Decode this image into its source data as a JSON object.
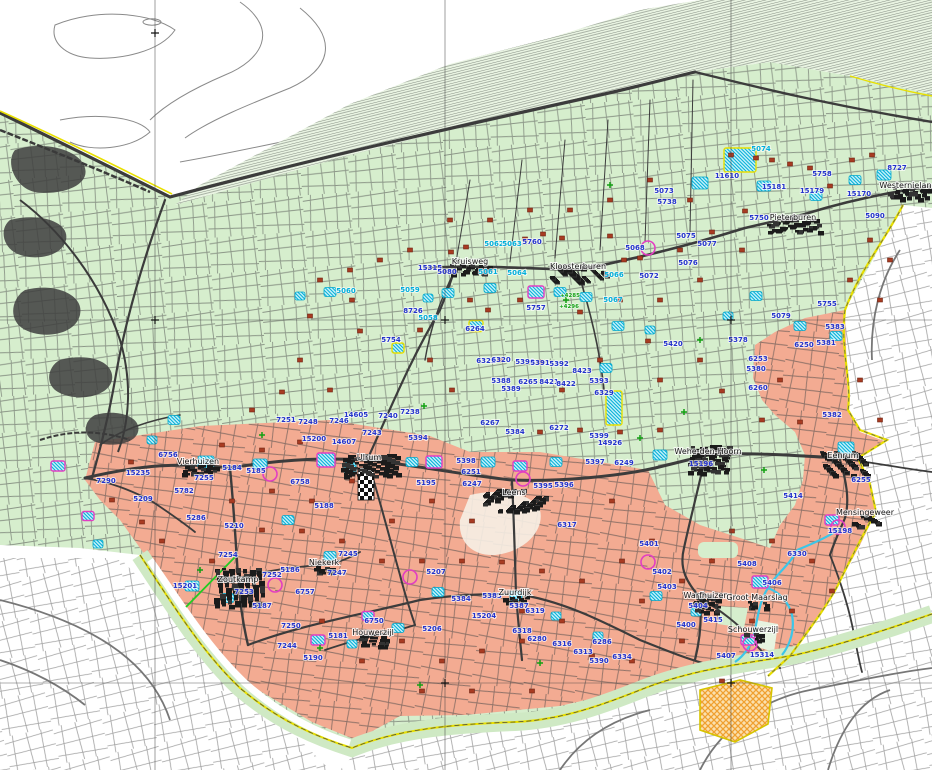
{
  "map_title": "Topographic cadastral map - Noord-Groningen",
  "colors": {
    "green_region": "#d6eecd",
    "marsh_region": "#e9f4e2",
    "salmon_region": "#f3ab92",
    "blue_label": "#2333cc",
    "cyan_label": "#00aeda",
    "green_label": "#12a012",
    "road": "#3c3c3c",
    "light_parcel": "#8f8f8f",
    "yellow_boundary": "#e8df00",
    "river": "#3cc6e8",
    "farm_marker": "#a83b22",
    "magenta_marker": "#e23ec2",
    "orange_hatch": "#f0a030",
    "town_text": "#151515"
  },
  "towns": [
    {
      "name": "Kruisweg",
      "x": 470,
      "y": 264,
      "bw": 40,
      "bh": 10
    },
    {
      "name": "Kloosterburen",
      "x": 578,
      "y": 269,
      "bw": 56,
      "bh": 16
    },
    {
      "name": "Pieterburen",
      "x": 793,
      "y": 220,
      "bw": 52,
      "bh": 14
    },
    {
      "name": "Westernieland",
      "x": 908,
      "y": 188,
      "bw": 42,
      "bh": 12
    },
    {
      "name": "Vierhuizen",
      "x": 198,
      "y": 464,
      "bw": 34,
      "bh": 10
    },
    {
      "name": "Ulrum",
      "x": 369,
      "y": 460,
      "bw": 56,
      "bh": 22
    },
    {
      "name": "Leens",
      "x": 514,
      "y": 495,
      "bw": 62,
      "bh": 22
    },
    {
      "name": "Wehe-den-Hoorn",
      "x": 708,
      "y": 454,
      "bw": 40,
      "bh": 28
    },
    {
      "name": "Eenrum",
      "x": 843,
      "y": 458,
      "bw": 46,
      "bh": 24
    },
    {
      "name": "Mensingeweer",
      "x": 865,
      "y": 515,
      "bw": 26,
      "bh": 12
    },
    {
      "name": "Zoutkamp",
      "x": 238,
      "y": 582,
      "bw": 48,
      "bh": 38
    },
    {
      "name": "Niekerk",
      "x": 324,
      "y": 565,
      "bw": 20,
      "bh": 8
    },
    {
      "name": "Houwerzijl",
      "x": 373,
      "y": 635,
      "bw": 28,
      "bh": 12
    },
    {
      "name": "Zuurdijk",
      "x": 515,
      "y": 595,
      "bw": 24,
      "bh": 8
    },
    {
      "name": "Warfhuizen",
      "x": 706,
      "y": 598,
      "bw": 26,
      "bh": 18
    },
    {
      "name": "Groot Maarslag",
      "x": 757,
      "y": 600,
      "bw": 18,
      "bh": 8
    },
    {
      "name": "Schouwerzijl",
      "x": 753,
      "y": 632,
      "bw": 18,
      "bh": 8
    }
  ],
  "labels_blue": [
    [
      "11610",
      727,
      178
    ],
    [
      "15181",
      774,
      189
    ],
    [
      "5758",
      822,
      176
    ],
    [
      "15179",
      812,
      193
    ],
    [
      "15170",
      859,
      196
    ],
    [
      "8727",
      897,
      170
    ],
    [
      "5750",
      759,
      220
    ],
    [
      "5090",
      875,
      218
    ],
    [
      "5760",
      532,
      244
    ],
    [
      "15315",
      430,
      270
    ],
    [
      "5080",
      447,
      274
    ],
    [
      "5757",
      536,
      310
    ],
    [
      "8726",
      413,
      313
    ],
    [
      "5754",
      391,
      342
    ],
    [
      "6264",
      475,
      331
    ],
    [
      "14605",
      356,
      417
    ],
    [
      "7240",
      388,
      418
    ],
    [
      "7238",
      410,
      414
    ],
    [
      "7251",
      286,
      422
    ],
    [
      "7248",
      308,
      424
    ],
    [
      "7246",
      339,
      423
    ],
    [
      "7243",
      372,
      435
    ],
    [
      "15200",
      314,
      441
    ],
    [
      "14607",
      344,
      444
    ],
    [
      "6756",
      168,
      457
    ],
    [
      "5184",
      232,
      470
    ],
    [
      "7255",
      204,
      480
    ],
    [
      "5185",
      256,
      473
    ],
    [
      "6758",
      300,
      484
    ],
    [
      "5782",
      184,
      493
    ],
    [
      "5286",
      196,
      520
    ],
    [
      "5210",
      234,
      528
    ],
    [
      "5188",
      324,
      508
    ],
    [
      "7290",
      106,
      483
    ],
    [
      "15235",
      138,
      475
    ],
    [
      "5209",
      143,
      501
    ],
    [
      "5394",
      418,
      440
    ],
    [
      "5195",
      426,
      485
    ],
    [
      "5398",
      466,
      463
    ],
    [
      "6251",
      471,
      474
    ],
    [
      "6247",
      472,
      486
    ],
    [
      "14926",
      610,
      445
    ],
    [
      "5397",
      595,
      464
    ],
    [
      "6249",
      624,
      465
    ],
    [
      "5395",
      543,
      488
    ],
    [
      "5396",
      564,
      487
    ],
    [
      "6317",
      567,
      527
    ],
    [
      "15196",
      701,
      466
    ],
    [
      "5414",
      793,
      498
    ],
    [
      "5382",
      832,
      417
    ],
    [
      "6255",
      861,
      482
    ],
    [
      "15198",
      840,
      533
    ],
    [
      "7254",
      228,
      557
    ],
    [
      "15201",
      185,
      588
    ],
    [
      "7252",
      272,
      577
    ],
    [
      "7253",
      244,
      594
    ],
    [
      "5186",
      290,
      572
    ],
    [
      "7245",
      348,
      556
    ],
    [
      "7247",
      337,
      575
    ],
    [
      "6757",
      305,
      594
    ],
    [
      "5187",
      262,
      608
    ],
    [
      "7250",
      291,
      628
    ],
    [
      "7244",
      287,
      648
    ],
    [
      "5181",
      338,
      638
    ],
    [
      "5190",
      313,
      660
    ],
    [
      "6750",
      374,
      623
    ],
    [
      "5206",
      432,
      631
    ],
    [
      "15204",
      484,
      618
    ],
    [
      "5207",
      436,
      574
    ],
    [
      "5384",
      461,
      601
    ],
    [
      "5385",
      492,
      598
    ],
    [
      "5387",
      519,
      608
    ],
    [
      "6319",
      535,
      613
    ],
    [
      "6318",
      522,
      633
    ],
    [
      "6280",
      537,
      641
    ],
    [
      "6316",
      562,
      646
    ],
    [
      "6313",
      583,
      654
    ],
    [
      "6286",
      602,
      644
    ],
    [
      "5390",
      599,
      663
    ],
    [
      "6334",
      622,
      659
    ],
    [
      "5401",
      649,
      546
    ],
    [
      "5402",
      662,
      574
    ],
    [
      "5403",
      667,
      589
    ],
    [
      "5404",
      698,
      608
    ],
    [
      "5400",
      686,
      627
    ],
    [
      "5415",
      713,
      622
    ],
    [
      "5408",
      747,
      566
    ],
    [
      "5406",
      772,
      585
    ],
    [
      "6330",
      797,
      556
    ],
    [
      "5407",
      726,
      658
    ],
    [
      "15314",
      762,
      657
    ],
    [
      "5755",
      827,
      306
    ],
    [
      "5079",
      781,
      318
    ],
    [
      "5378",
      738,
      342
    ],
    [
      "5383",
      835,
      329
    ],
    [
      "5381",
      826,
      345
    ],
    [
      "6250",
      804,
      347
    ],
    [
      "6253",
      758,
      361
    ],
    [
      "5380",
      756,
      371
    ],
    [
      "6260",
      758,
      390
    ],
    [
      "6321",
      486,
      363
    ],
    [
      "6320",
      501,
      362
    ],
    [
      "5390",
      525,
      364
    ],
    [
      "5391",
      540,
      365
    ],
    [
      "5392",
      559,
      366
    ],
    [
      "8423",
      582,
      373
    ],
    [
      "5388",
      501,
      383
    ],
    [
      "6265",
      528,
      384
    ],
    [
      "8421",
      549,
      384
    ],
    [
      "8422",
      566,
      386
    ],
    [
      "5393",
      599,
      383
    ],
    [
      "5389",
      511,
      391
    ],
    [
      "6329",
      604,
      395
    ],
    [
      "6267",
      490,
      425
    ],
    [
      "5384",
      515,
      434
    ],
    [
      "6272",
      559,
      430
    ],
    [
      "5399",
      599,
      438
    ],
    [
      "5420",
      673,
      346
    ],
    [
      "5073",
      664,
      193
    ],
    [
      "5738",
      667,
      204
    ],
    [
      "5075",
      686,
      238
    ],
    [
      "5077",
      707,
      246
    ],
    [
      "5076",
      688,
      265
    ],
    [
      "5068",
      635,
      250
    ],
    [
      "5072",
      649,
      278
    ]
  ],
  "labels_cyan": [
    [
      "5074",
      761,
      151
    ],
    [
      "5062",
      494,
      246
    ],
    [
      "5063",
      512,
      246
    ],
    [
      "5061",
      488,
      274
    ],
    [
      "5064",
      517,
      275
    ],
    [
      "5066",
      614,
      277
    ],
    [
      "5067",
      613,
      302
    ],
    [
      "5060",
      346,
      293
    ],
    [
      "5059",
      410,
      292
    ],
    [
      "5058",
      428,
      320
    ]
  ],
  "labels_green": [
    [
      "+4285",
      570,
      297
    ],
    [
      "+4296",
      569,
      308
    ]
  ],
  "farm_markers": [
    [
      451,
      252
    ],
    [
      466,
      247
    ],
    [
      525,
      239
    ],
    [
      543,
      234
    ],
    [
      562,
      238
    ],
    [
      610,
      236
    ],
    [
      640,
      258
    ],
    [
      680,
      250
    ],
    [
      712,
      232
    ],
    [
      745,
      211
    ],
    [
      772,
      160
    ],
    [
      731,
      155
    ],
    [
      756,
      158
    ],
    [
      790,
      164
    ],
    [
      810,
      168
    ],
    [
      830,
      186
    ],
    [
      852,
      160
    ],
    [
      872,
      155
    ],
    [
      620,
      300
    ],
    [
      580,
      312
    ],
    [
      520,
      300
    ],
    [
      488,
      310
    ],
    [
      470,
      300
    ],
    [
      420,
      330
    ],
    [
      352,
      300
    ],
    [
      310,
      316
    ],
    [
      360,
      331
    ],
    [
      300,
      360
    ],
    [
      330,
      390
    ],
    [
      282,
      392
    ],
    [
      252,
      410
    ],
    [
      430,
      360
    ],
    [
      452,
      390
    ],
    [
      500,
      360
    ],
    [
      540,
      362
    ],
    [
      562,
      390
    ],
    [
      600,
      360
    ],
    [
      648,
      341
    ],
    [
      660,
      380
    ],
    [
      700,
      360
    ],
    [
      722,
      391
    ],
    [
      780,
      380
    ],
    [
      800,
      422
    ],
    [
      762,
      420
    ],
    [
      660,
      430
    ],
    [
      620,
      432
    ],
    [
      580,
      430
    ],
    [
      540,
      432
    ],
    [
      300,
      442
    ],
    [
      262,
      450
    ],
    [
      222,
      445
    ],
    [
      131,
      462
    ],
    [
      112,
      500
    ],
    [
      142,
      522
    ],
    [
      162,
      541
    ],
    [
      212,
      561
    ],
    [
      262,
      530
    ],
    [
      302,
      531
    ],
    [
      342,
      541
    ],
    [
      382,
      561
    ],
    [
      422,
      561
    ],
    [
      462,
      561
    ],
    [
      502,
      562
    ],
    [
      542,
      571
    ],
    [
      582,
      581
    ],
    [
      622,
      561
    ],
    [
      642,
      601
    ],
    [
      682,
      641
    ],
    [
      722,
      681
    ],
    [
      562,
      621
    ],
    [
      522,
      641
    ],
    [
      482,
      651
    ],
    [
      442,
      661
    ],
    [
      402,
      641
    ],
    [
      362,
      661
    ],
    [
      322,
      621
    ],
    [
      422,
      691
    ],
    [
      472,
      691
    ],
    [
      532,
      691
    ],
    [
      592,
      656
    ],
    [
      632,
      661
    ],
    [
      522,
      611
    ],
    [
      352,
      481
    ],
    [
      312,
      501
    ],
    [
      272,
      491
    ],
    [
      232,
      501
    ],
    [
      432,
      501
    ],
    [
      472,
      521
    ],
    [
      392,
      521
    ],
    [
      612,
      501
    ],
    [
      652,
      541
    ],
    [
      732,
      531
    ],
    [
      772,
      541
    ],
    [
      812,
      561
    ],
    [
      832,
      591
    ],
    [
      792,
      611
    ],
    [
      752,
      621
    ],
    [
      712,
      561
    ],
    [
      682,
      581
    ],
    [
      742,
      250
    ],
    [
      700,
      280
    ],
    [
      660,
      300
    ],
    [
      624,
      260
    ],
    [
      690,
      200
    ],
    [
      650,
      180
    ],
    [
      610,
      200
    ],
    [
      570,
      210
    ],
    [
      530,
      210
    ],
    [
      490,
      220
    ],
    [
      450,
      220
    ],
    [
      410,
      250
    ],
    [
      380,
      260
    ],
    [
      350,
      270
    ],
    [
      320,
      280
    ],
    [
      870,
      240
    ],
    [
      890,
      260
    ],
    [
      850,
      280
    ],
    [
      880,
      300
    ],
    [
      860,
      380
    ],
    [
      880,
      420
    ]
  ],
  "cyan_sites": [
    [
      740,
      160,
      32,
      24,
      "y"
    ],
    [
      884,
      175,
      14,
      10,
      "n"
    ],
    [
      855,
      180,
      12,
      9,
      "n"
    ],
    [
      816,
      196,
      12,
      9,
      "n"
    ],
    [
      764,
      186,
      14,
      10,
      "n"
    ],
    [
      700,
      183,
      16,
      12,
      "n"
    ],
    [
      536,
      292,
      16,
      12,
      "m"
    ],
    [
      560,
      292,
      12,
      9,
      "n"
    ],
    [
      586,
      297,
      12,
      9,
      "n"
    ],
    [
      490,
      288,
      12,
      9,
      "n"
    ],
    [
      448,
      293,
      12,
      9,
      "n"
    ],
    [
      428,
      298,
      10,
      8,
      "n"
    ],
    [
      330,
      292,
      12,
      9,
      "n"
    ],
    [
      300,
      296,
      10,
      8,
      "n"
    ],
    [
      476,
      326,
      14,
      11,
      "y"
    ],
    [
      398,
      348,
      12,
      10,
      "y"
    ],
    [
      618,
      326,
      12,
      9,
      "n"
    ],
    [
      650,
      330,
      10,
      8,
      "n"
    ],
    [
      606,
      368,
      12,
      9,
      "n"
    ],
    [
      660,
      455,
      14,
      10,
      "n"
    ],
    [
      614,
      408,
      16,
      34,
      "y"
    ],
    [
      206,
      462,
      16,
      12,
      "n"
    ],
    [
      260,
      464,
      14,
      10,
      "n"
    ],
    [
      326,
      460,
      18,
      14,
      "m"
    ],
    [
      350,
      468,
      12,
      10,
      "n"
    ],
    [
      434,
      462,
      16,
      12,
      "m"
    ],
    [
      488,
      462,
      14,
      10,
      "n"
    ],
    [
      520,
      466,
      14,
      10,
      "m"
    ],
    [
      556,
      462,
      12,
      9,
      "n"
    ],
    [
      846,
      448,
      16,
      12,
      "n"
    ],
    [
      832,
      520,
      14,
      10,
      "m"
    ],
    [
      760,
      582,
      16,
      12,
      "m"
    ],
    [
      748,
      640,
      14,
      10,
      "m"
    ],
    [
      58,
      466,
      14,
      10,
      "m"
    ],
    [
      88,
      516,
      12,
      9,
      "m"
    ],
    [
      98,
      544,
      10,
      8,
      "n"
    ],
    [
      192,
      586,
      14,
      10,
      "n"
    ],
    [
      228,
      598,
      12,
      9,
      "n"
    ],
    [
      330,
      556,
      12,
      9,
      "n"
    ],
    [
      368,
      616,
      12,
      9,
      "m"
    ],
    [
      398,
      628,
      12,
      9,
      "n"
    ],
    [
      438,
      592,
      12,
      9,
      "n"
    ],
    [
      516,
      596,
      12,
      9,
      "n"
    ],
    [
      556,
      616,
      10,
      8,
      "n"
    ],
    [
      598,
      636,
      10,
      8,
      "n"
    ],
    [
      656,
      596,
      12,
      9,
      "n"
    ],
    [
      696,
      612,
      10,
      8,
      "n"
    ],
    [
      174,
      420,
      12,
      9,
      "n"
    ],
    [
      152,
      440,
      10,
      8,
      "n"
    ],
    [
      800,
      326,
      12,
      9,
      "n"
    ],
    [
      836,
      336,
      12,
      9,
      "n"
    ],
    [
      756,
      296,
      12,
      9,
      "n"
    ],
    [
      728,
      316,
      10,
      8,
      "n"
    ],
    [
      412,
      462,
      12,
      9,
      "n"
    ],
    [
      288,
      520,
      12,
      9,
      "n"
    ],
    [
      318,
      640,
      14,
      10,
      "m"
    ],
    [
      352,
      644,
      10,
      8,
      "n"
    ]
  ],
  "magenta_circles": [
    [
      275,
      585
    ],
    [
      648,
      562
    ],
    [
      838,
      527
    ],
    [
      648,
      248
    ],
    [
      523,
      479
    ],
    [
      270,
      474
    ],
    [
      410,
      577
    ],
    [
      750,
      644
    ]
  ],
  "green_marks": [
    [
      566,
      300
    ],
    [
      640,
      438
    ],
    [
      700,
      340
    ],
    [
      424,
      406
    ],
    [
      262,
      435
    ],
    [
      320,
      648
    ],
    [
      540,
      663
    ],
    [
      764,
      470
    ],
    [
      610,
      185
    ],
    [
      684,
      412
    ],
    [
      200,
      570
    ],
    [
      420,
      685
    ]
  ]
}
